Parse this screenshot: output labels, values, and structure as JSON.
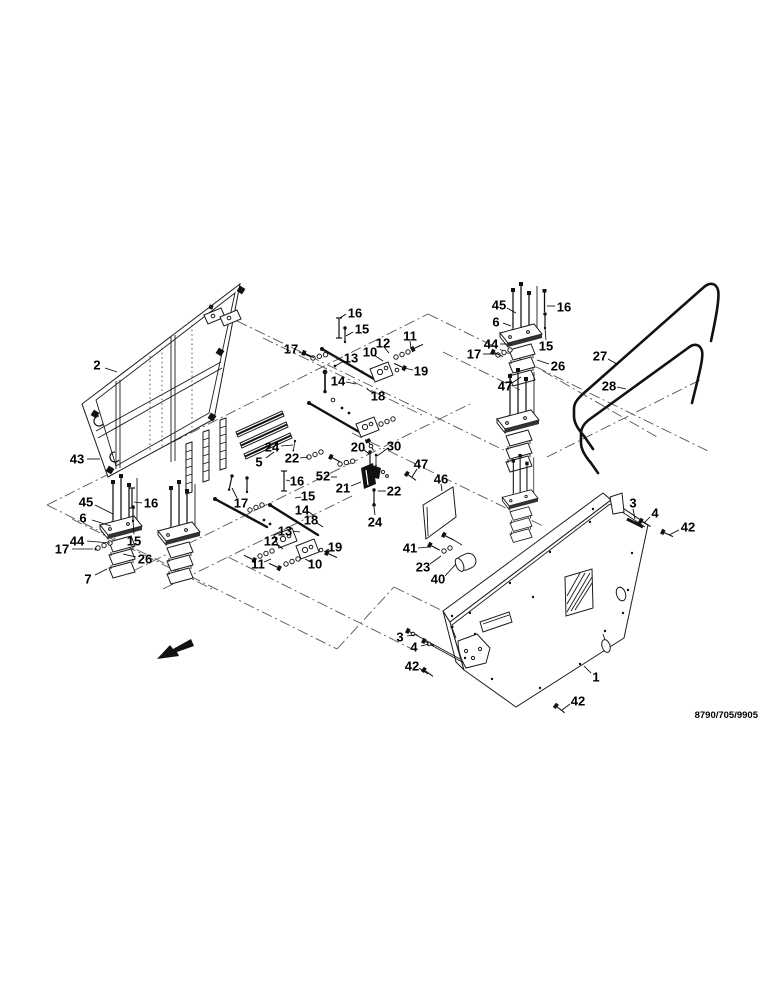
{
  "figure": {
    "ref_code": "8790/705/9905",
    "type": "exploded-parts-diagram"
  },
  "callouts": [
    {
      "n": "2",
      "x": 97,
      "y": 365,
      "l": [
        105,
        368,
        117,
        372
      ]
    },
    {
      "n": "43",
      "x": 77,
      "y": 459,
      "l": [
        87,
        459,
        100,
        459
      ]
    },
    {
      "n": "45",
      "x": 86,
      "y": 502,
      "l": [
        95,
        505,
        113,
        514
      ]
    },
    {
      "n": "16",
      "x": 151,
      "y": 503,
      "l": [
        142,
        503,
        134,
        502
      ]
    },
    {
      "n": "6",
      "x": 83,
      "y": 518,
      "l": [
        92,
        520,
        111,
        526
      ]
    },
    {
      "n": "44",
      "x": 77,
      "y": 541,
      "l": [
        87,
        541,
        110,
        543
      ]
    },
    {
      "n": "17",
      "x": 62,
      "y": 549,
      "l": [
        72,
        549,
        93,
        549
      ]
    },
    {
      "n": "15",
      "x": 134,
      "y": 541,
      "l": [
        134,
        534,
        133,
        521
      ]
    },
    {
      "n": "26",
      "x": 145,
      "y": 559,
      "l": [
        136,
        557,
        123,
        554
      ]
    },
    {
      "n": "7",
      "x": 88,
      "y": 579,
      "l": [
        95,
        575,
        107,
        569
      ]
    },
    {
      "n": "16",
      "x": 355,
      "y": 313,
      "l": [
        346,
        314,
        340,
        318
      ]
    },
    {
      "n": "15",
      "x": 362,
      "y": 329,
      "l": [
        353,
        332,
        346,
        336
      ]
    },
    {
      "n": "17",
      "x": 291,
      "y": 349,
      "l": [
        299,
        352,
        311,
        357
      ]
    },
    {
      "n": "13",
      "x": 351,
      "y": 358,
      "l": [
        344,
        361,
        335,
        366
      ]
    },
    {
      "n": "12",
      "x": 383,
      "y": 343,
      "l": [
        384,
        347,
        389,
        353
      ]
    },
    {
      "n": "10",
      "x": 370,
      "y": 352,
      "l": [
        374,
        355,
        383,
        361
      ]
    },
    {
      "n": "11",
      "x": 410,
      "y": 336,
      "l": [
        410,
        341,
        411,
        349
      ]
    },
    {
      "n": "19",
      "x": 421,
      "y": 371,
      "l": [
        413,
        370,
        404,
        368
      ]
    },
    {
      "n": "14",
      "x": 338,
      "y": 381,
      "l": [
        346,
        382,
        356,
        384
      ]
    },
    {
      "n": "18",
      "x": 378,
      "y": 396,
      "l": [
        373,
        393,
        367,
        389
      ]
    },
    {
      "n": "17",
      "x": 474,
      "y": 354,
      "l": [
        483,
        354,
        496,
        354
      ]
    },
    {
      "n": "45",
      "x": 499,
      "y": 305,
      "l": [
        507,
        308,
        516,
        313
      ]
    },
    {
      "n": "16",
      "x": 564,
      "y": 307,
      "l": [
        555,
        306,
        547,
        306
      ]
    },
    {
      "n": "6",
      "x": 496,
      "y": 322,
      "l": [
        503,
        323,
        511,
        326
      ]
    },
    {
      "n": "44",
      "x": 491,
      "y": 344,
      "l": [
        500,
        344,
        511,
        344
      ]
    },
    {
      "n": "15",
      "x": 546,
      "y": 346,
      "l": [
        546,
        340,
        545,
        328
      ]
    },
    {
      "n": "26",
      "x": 558,
      "y": 366,
      "l": [
        549,
        364,
        537,
        360
      ]
    },
    {
      "n": "47",
      "x": 505,
      "y": 386,
      "l": [
        512,
        383,
        521,
        377
      ]
    },
    {
      "n": "27",
      "x": 600,
      "y": 356,
      "l": [
        608,
        359,
        617,
        364
      ]
    },
    {
      "n": "28",
      "x": 609,
      "y": 386,
      "l": [
        617,
        387,
        626,
        389
      ]
    },
    {
      "n": "24",
      "x": 272,
      "y": 447,
      "l": [
        281,
        446,
        293,
        445
      ]
    },
    {
      "n": "22",
      "x": 292,
      "y": 458,
      "l": [
        300,
        458,
        308,
        457
      ]
    },
    {
      "n": "5",
      "x": 259,
      "y": 462,
      "l": [
        266,
        458,
        274,
        452
      ]
    },
    {
      "n": "16",
      "x": 297,
      "y": 481,
      "l": [
        290,
        481,
        286,
        480
      ]
    },
    {
      "n": "20",
      "x": 358,
      "y": 447,
      "l": [
        363,
        449,
        369,
        454
      ]
    },
    {
      "n": "30",
      "x": 394,
      "y": 446,
      "l": [
        388,
        448,
        377,
        456
      ]
    },
    {
      "n": "52",
      "x": 323,
      "y": 476,
      "l": [
        331,
        477,
        337,
        477
      ]
    },
    {
      "n": "21",
      "x": 343,
      "y": 488,
      "l": [
        351,
        486,
        361,
        482
      ]
    },
    {
      "n": "22",
      "x": 394,
      "y": 491,
      "l": [
        386,
        491,
        378,
        491
      ]
    },
    {
      "n": "24",
      "x": 375,
      "y": 522,
      "l": [
        375,
        515,
        374,
        507
      ]
    },
    {
      "n": "47",
      "x": 421,
      "y": 464,
      "l": [
        417,
        469,
        412,
        477
      ]
    },
    {
      "n": "46",
      "x": 441,
      "y": 479,
      "l": [
        441,
        484,
        442,
        491
      ]
    },
    {
      "n": "15",
      "x": 308,
      "y": 496,
      "l": [
        301,
        497,
        295,
        498
      ]
    },
    {
      "n": "17",
      "x": 241,
      "y": 503,
      "l": [
        237,
        498,
        232,
        488
      ]
    },
    {
      "n": "14",
      "x": 302,
      "y": 510,
      "l": [
        309,
        512,
        317,
        518
      ]
    },
    {
      "n": "18",
      "x": 311,
      "y": 520,
      "l": [
        317,
        523,
        323,
        527
      ]
    },
    {
      "n": "13",
      "x": 285,
      "y": 531,
      "l": [
        293,
        531,
        300,
        532
      ]
    },
    {
      "n": "12",
      "x": 271,
      "y": 541,
      "l": [
        277,
        544,
        283,
        549
      ]
    },
    {
      "n": "19",
      "x": 335,
      "y": 547,
      "l": [
        329,
        549,
        324,
        552
      ]
    },
    {
      "n": "11",
      "x": 258,
      "y": 564,
      "l": [
        264,
        562,
        271,
        559
      ]
    },
    {
      "n": "10",
      "x": 315,
      "y": 564,
      "l": [
        311,
        562,
        305,
        559
      ]
    },
    {
      "n": "41",
      "x": 410,
      "y": 548,
      "l": [
        418,
        548,
        429,
        547
      ]
    },
    {
      "n": "23",
      "x": 423,
      "y": 567,
      "l": [
        430,
        564,
        441,
        556
      ]
    },
    {
      "n": "40",
      "x": 438,
      "y": 579,
      "l": [
        445,
        576,
        456,
        564
      ]
    },
    {
      "n": "3",
      "x": 633,
      "y": 503,
      "l": [
        633,
        509,
        635,
        519
      ]
    },
    {
      "n": "4",
      "x": 655,
      "y": 513,
      "l": [
        650,
        517,
        644,
        523
      ]
    },
    {
      "n": "42",
      "x": 688,
      "y": 527,
      "l": [
        679,
        530,
        669,
        535
      ]
    },
    {
      "n": "1",
      "x": 596,
      "y": 677,
      "l": [
        591,
        673,
        584,
        666
      ]
    },
    {
      "n": "42",
      "x": 578,
      "y": 701,
      "l": [
        570,
        704,
        562,
        710
      ]
    },
    {
      "n": "3",
      "x": 400,
      "y": 637,
      "l": [
        407,
        636,
        414,
        635
      ]
    },
    {
      "n": "4",
      "x": 414,
      "y": 647,
      "l": [
        421,
        646,
        429,
        644
      ]
    },
    {
      "n": "42",
      "x": 412,
      "y": 666,
      "l": [
        419,
        668,
        428,
        674
      ]
    }
  ]
}
